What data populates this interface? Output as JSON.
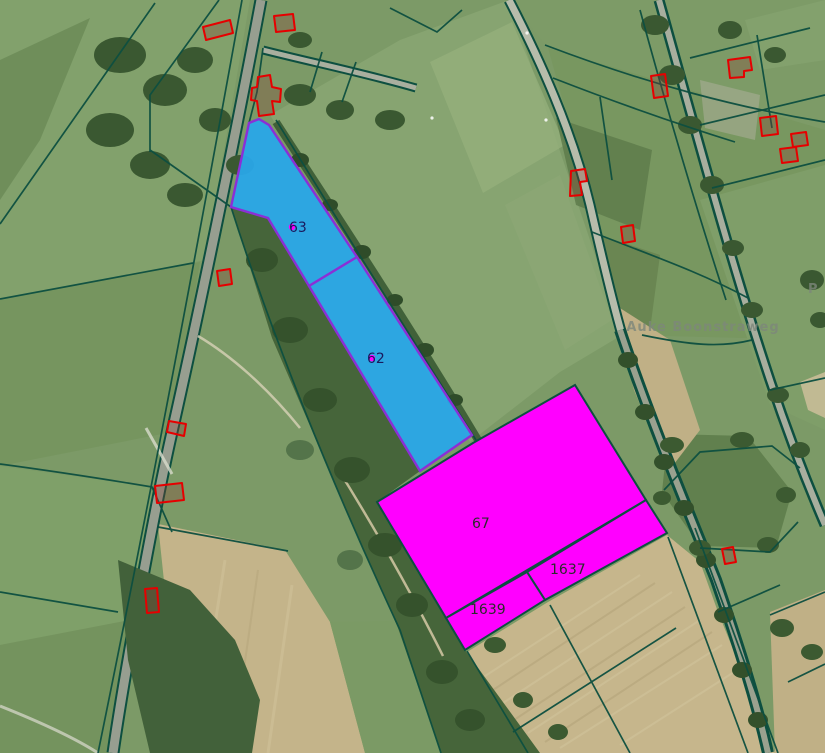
{
  "map": {
    "title": "cadastral-aerial-view",
    "street_labels": [
      {
        "text": "Auke Boonstraweg"
      },
      {
        "text": "P"
      }
    ],
    "parcel_labels": {
      "blue": [
        {
          "id": "63"
        },
        {
          "id": "62"
        }
      ],
      "magenta": [
        {
          "id": "67"
        },
        {
          "id": "1637"
        },
        {
          "id": "1639"
        }
      ]
    },
    "colors": {
      "parcel_blue_fill": "#29A7E8",
      "parcel_blue_outline": "#8B2FD6",
      "parcel_magenta_fill": "#FF00FF",
      "parcel_magenta_outline": "#0D4F40",
      "boundary_line": "#0D4F40",
      "building_outline": "#E60000",
      "label_blue_text": "#1A1A5E",
      "label_magenta_text": "#2B2B2B",
      "street_label_text": "#7D877B",
      "centroid_dot": "#FF00FF"
    }
  }
}
